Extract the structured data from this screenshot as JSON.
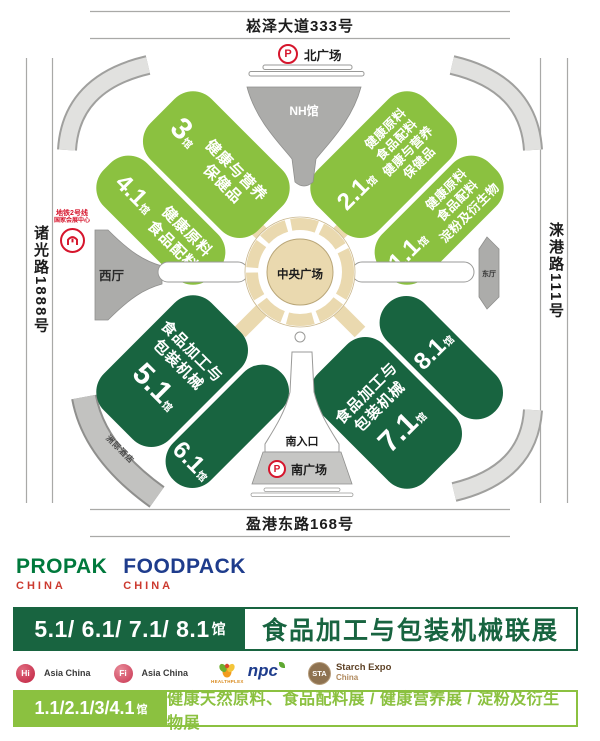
{
  "colors": {
    "light_green": "#8BC140",
    "dark_green": "#186440",
    "metro_red": "#D6152C",
    "propak_green": "#00793C",
    "foodpack_navy": "#1E3C8C",
    "china_red": "#CC3A2F",
    "tan": "#EAD9AF",
    "gray": "#ACACAA"
  },
  "map": {
    "roads": {
      "north": "崧泽大道333号",
      "south": "盈港东路168号",
      "west": "诸光路1888号",
      "east": "涞港路111号"
    },
    "labels": {
      "parking": "P",
      "north_plaza": "北广场",
      "south_plaza": "南广场",
      "south_entrance": "南入口",
      "nh_hall": "NH馆",
      "west_hall": "西厅",
      "east_hall": "东厅",
      "central_plaza": "中央广场",
      "hotel": "洲际酒店",
      "metro_line": "地铁2号线",
      "metro_station": "国家会展中心"
    },
    "halls": {
      "h3": {
        "no": "3",
        "suffix": "馆",
        "lines": [
          "健康与营养",
          "保健品"
        ]
      },
      "h41": {
        "no": "4.1",
        "suffix": "馆",
        "lines": [
          "健康原料",
          "食品配料"
        ]
      },
      "h21": {
        "no": "2.1",
        "suffix": "馆",
        "lines": [
          "健康原料",
          "食品配料",
          "健康与营养",
          "保健品"
        ]
      },
      "h11": {
        "no": "1.1",
        "suffix": "馆",
        "lines": [
          "健康原料",
          "食品配料",
          "淀粉及衍生物"
        ]
      },
      "h51": {
        "no": "5.1",
        "suffix": "馆",
        "lines": [
          "食品加工与",
          "包装机械"
        ]
      },
      "h61": {
        "no": "6.1",
        "suffix": "馆"
      },
      "h71": {
        "no": "7.1",
        "suffix": "馆",
        "lines": [
          "食品加工与",
          "包装机械"
        ]
      },
      "h81": {
        "no": "8.1",
        "suffix": "馆"
      }
    }
  },
  "footer": {
    "logos": {
      "propak": "PROPAK",
      "propak_sub": "CHINA",
      "foodpack": "FOODPACK",
      "foodpack_sub": "CHINA"
    },
    "banner1": {
      "halls_numbers": "5.1/ 6.1/ 7.1/ 8.1",
      "halls_suffix": "馆",
      "title": "食品加工与包装机械联展"
    },
    "partners": [
      {
        "badge": "Hi",
        "label": "Asia China"
      },
      {
        "badge": "Fi",
        "label": "Asia China"
      },
      {
        "badge": "npc",
        "label": "HEALTHPLEX"
      },
      {
        "badge": "STA",
        "label": "Starch Expo",
        "sub": "China"
      }
    ],
    "banner2": {
      "halls_numbers": "1.1/2.1/3/4.1",
      "halls_suffix": "馆",
      "title": "健康天然原料、食品配料展 / 健康营养展 / 淀粉及衍生物展"
    }
  }
}
